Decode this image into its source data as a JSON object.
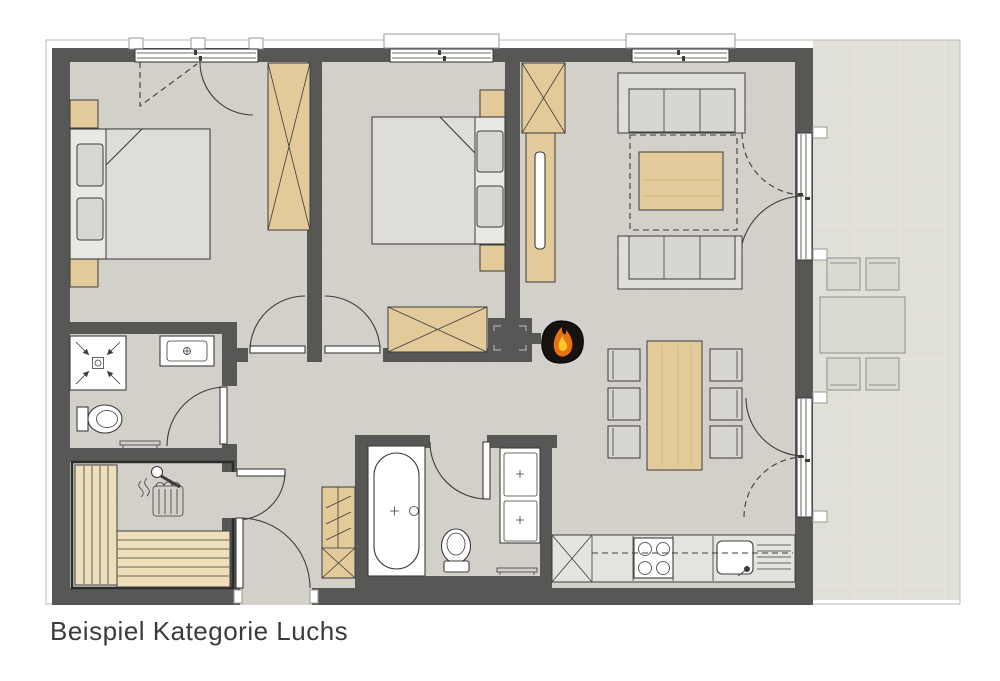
{
  "caption": "Beispiel Kategorie Luchs",
  "palette": {
    "wall": "#575756",
    "floor": "#d3d0ca",
    "floor_grid": "#dbd8d2",
    "terrace": "#e1e0d7",
    "terrace_grid": "#eae9e1",
    "wood": "#e2ca9b",
    "wood_light": "#eedfba",
    "upholstery": "#dfdedb",
    "upholstery_seat": "#d7d6d3",
    "fixture_white": "#ffffff",
    "outline": "#3c3c3b",
    "kitchen_counter": "#e4e3e0",
    "stove_body": "#17120e",
    "fire_orange": "#e8720f",
    "fire_yellow": "#fdc62c",
    "frame_line": "#c5c4bf"
  },
  "furniture_icons": [
    "double-bed-icon",
    "pillow-icon",
    "nightstand-icon",
    "wardrobe-icon",
    "sofa-icon",
    "coffee-table-icon",
    "rug-icon",
    "tv-sideboard-icon",
    "dining-table-icon",
    "chair-icon",
    "terrace-table-icon",
    "terrace-chair-icon",
    "kitchen-stove-icon",
    "kitchen-sink-icon",
    "kitchen-cabinet-icon",
    "bathtub-icon",
    "toilet-icon",
    "washbasin-icon",
    "double-washbasin-icon",
    "shower-icon",
    "bench-icon",
    "shelf-cabinet-icon",
    "sauna-bench-icon",
    "sauna-heater-icon",
    "wood-stove-fire-icon",
    "window-icon",
    "door-swing-icon",
    "terrace-door-icon"
  ]
}
